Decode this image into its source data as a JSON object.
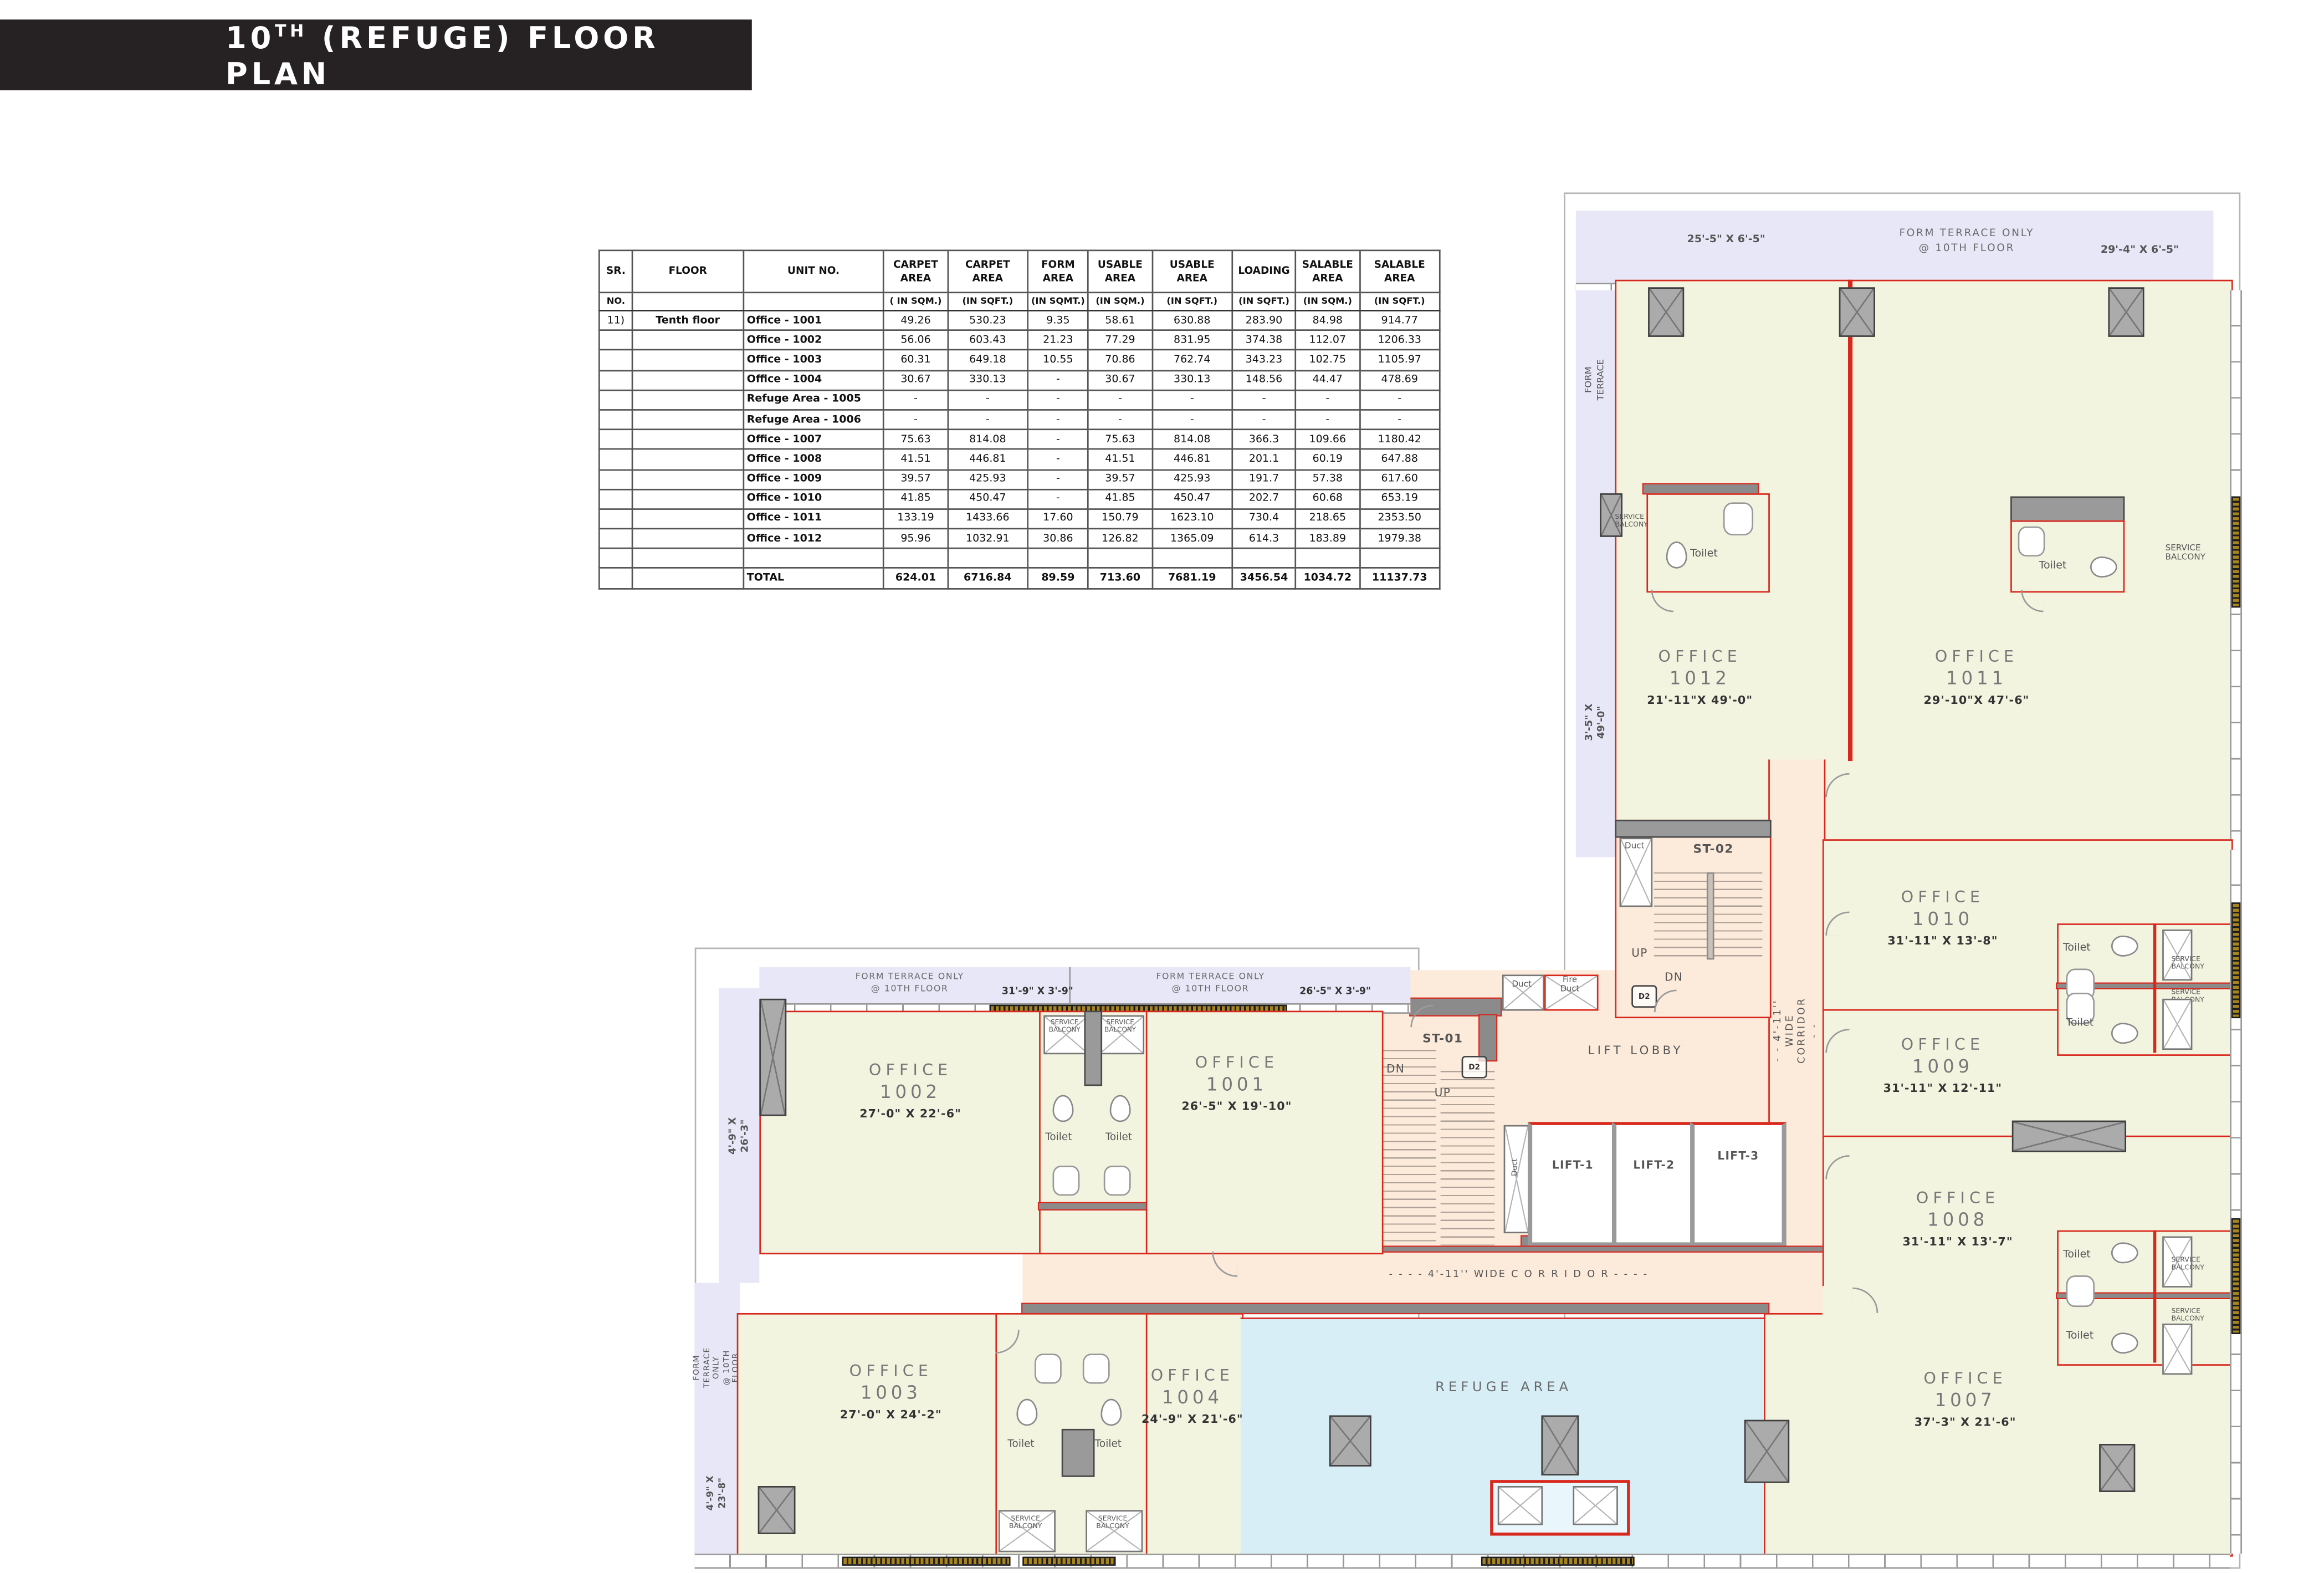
{
  "title": {
    "prefix": "10",
    "sup": "TH",
    "rest": " (REFUGE) FLOOR PLAN"
  },
  "area_table": {
    "headers": [
      {
        "t": "SR.",
        "u": "NO."
      },
      {
        "t": "FLOOR",
        "u": ""
      },
      {
        "t": "UNIT NO.",
        "u": ""
      },
      {
        "t": "CARPET\nAREA",
        "u": "( IN SQM.)"
      },
      {
        "t": "CARPET AREA",
        "u": "(IN SQFT.)"
      },
      {
        "t": "FORM\nAREA",
        "u": "(IN SQMT.)"
      },
      {
        "t": "USABLE\nAREA",
        "u": "(IN SQM.)"
      },
      {
        "t": "USABLE AREA",
        "u": "(IN SQFT.)"
      },
      {
        "t": "LOADING",
        "u": "(IN SQFT.)"
      },
      {
        "t": "SALABLE\nAREA",
        "u": "(IN SQM.)"
      },
      {
        "t": "SALABLE\nAREA",
        "u": "(IN SQFT.)"
      }
    ],
    "rows": [
      [
        "11)",
        "Tenth floor",
        "Office - 1001",
        "49.26",
        "530.23",
        "9.35",
        "58.61",
        "630.88",
        "283.90",
        "84.98",
        "914.77"
      ],
      [
        "",
        "",
        "Office - 1002",
        "56.06",
        "603.43",
        "21.23",
        "77.29",
        "831.95",
        "374.38",
        "112.07",
        "1206.33"
      ],
      [
        "",
        "",
        "Office - 1003",
        "60.31",
        "649.18",
        "10.55",
        "70.86",
        "762.74",
        "343.23",
        "102.75",
        "1105.97"
      ],
      [
        "",
        "",
        "Office - 1004",
        "30.67",
        "330.13",
        "-",
        "30.67",
        "330.13",
        "148.56",
        "44.47",
        "478.69"
      ],
      [
        "",
        "",
        "Refuge Area - 1005",
        "-",
        "-",
        "-",
        "-",
        "-",
        "-",
        "-",
        "-"
      ],
      [
        "",
        "",
        "Refuge Area - 1006",
        "-",
        "-",
        "-",
        "-",
        "-",
        "-",
        "-",
        "-"
      ],
      [
        "",
        "",
        "Office - 1007",
        "75.63",
        "814.08",
        "-",
        "75.63",
        "814.08",
        "366.3",
        "109.66",
        "1180.42"
      ],
      [
        "",
        "",
        "Office - 1008",
        "41.51",
        "446.81",
        "-",
        "41.51",
        "446.81",
        "201.1",
        "60.19",
        "647.88"
      ],
      [
        "",
        "",
        "Office - 1009",
        "39.57",
        "425.93",
        "-",
        "39.57",
        "425.93",
        "191.7",
        "57.38",
        "617.60"
      ],
      [
        "",
        "",
        "Office - 1010",
        "41.85",
        "450.47",
        "-",
        "41.85",
        "450.47",
        "202.7",
        "60.68",
        "653.19"
      ],
      [
        "",
        "",
        "Office - 1011",
        "133.19",
        "1433.66",
        "17.60",
        "150.79",
        "1623.10",
        "730.4",
        "218.65",
        "2353.50"
      ],
      [
        "",
        "",
        "Office - 1012",
        "95.96",
        "1032.91",
        "30.86",
        "126.82",
        "1365.09",
        "614.3",
        "183.89",
        "1979.38"
      ],
      [
        "",
        "",
        "",
        "",
        "",
        "",
        "",
        "",
        "",
        "",
        ""
      ],
      [
        "",
        "",
        "TOTAL",
        "624.01",
        "6716.84",
        "89.59",
        "713.60",
        "7681.19",
        "3456.54",
        "1034.72",
        "11137.73"
      ]
    ]
  },
  "plan": {
    "north": {
      "terr_dim_left": "25'-5\" X 6'-5\"",
      "terr_title": "FORM TERRACE ONLY",
      "terr_sub": "@ 10TH FLOOR",
      "terr_dim_right": "29'-4\" X 6'-5\"",
      "terr_left": "FORM\nTERRACE",
      "terr_left_dim": "3'-5\" X 49'-0\""
    },
    "west": {
      "terr1_title": "FORM TERRACE ONLY",
      "terr1_sub": "@ 10TH FLOOR",
      "terr1_dim": "31'-9\" X 3'-9\"",
      "terr2_title": "FORM TERRACE ONLY",
      "terr2_sub": "@ 10TH FLOOR",
      "terr2_dim": "26'-5\" X 3'-9\"",
      "terr_left_dim": "4'-9\" X 26'-3\"",
      "terr3_title": "FORM TERRACE ONLY\n@ 10TH FLOOR",
      "terr3_dim": "4'-9\" X 23'-8\""
    },
    "offices": {
      "o1001": {
        "t": "OFFICE",
        "n": "1001",
        "d": "26'-5\" X 19'-10\""
      },
      "o1002": {
        "t": "OFFICE",
        "n": "1002",
        "d": "27'-0\" X 22'-6\""
      },
      "o1003": {
        "t": "OFFICE",
        "n": "1003",
        "d": "27'-0\" X 24'-2\""
      },
      "o1004": {
        "t": "OFFICE",
        "n": "1004",
        "d": "24'-9\" X 21'-6\""
      },
      "o1007": {
        "t": "OFFICE",
        "n": "1007",
        "d": "37'-3\" X 21'-6\""
      },
      "o1008": {
        "t": "OFFICE",
        "n": "1008",
        "d": "31'-11\" X 13'-7\""
      },
      "o1009": {
        "t": "OFFICE",
        "n": "1009",
        "d": "31'-11\" X 12'-11\""
      },
      "o1010": {
        "t": "OFFICE",
        "n": "1010",
        "d": "31'-11\" X 13'-8\""
      },
      "o1011": {
        "t": "OFFICE",
        "n": "1011",
        "d": "29'-10\"X 47'-6\""
      },
      "o1012": {
        "t": "OFFICE",
        "n": "1012",
        "d": "21'-11\"X 49'-0\""
      }
    },
    "refuge_label": "REFUGE AREA",
    "core": {
      "st01": "ST-01",
      "st02": "ST-02",
      "lift_lobby": "LIFT LOBBY",
      "lift1": "LIFT-1",
      "lift2": "LIFT-2",
      "lift3": "LIFT-3",
      "duct": "Duct",
      "fire_duct": "Fire\nDuct",
      "d2": "D2",
      "up": "UP",
      "dn": "DN"
    },
    "corridors": {
      "v": "- - 4'-11''  WIDE  CORRIDOR - -",
      "h": "- - - -  4'-11''  WIDE  C O R R I D O R  - - - -"
    },
    "labels": {
      "toilet": "Toilet",
      "sb": "SERVICE\nBALCONY"
    }
  }
}
